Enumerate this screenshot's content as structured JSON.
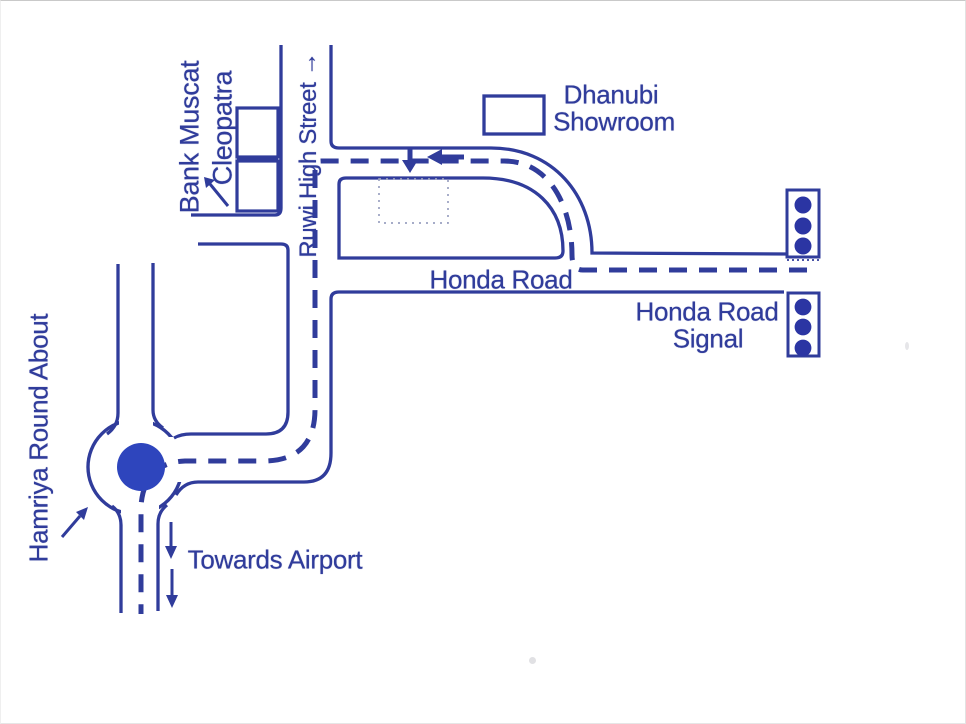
{
  "document": {
    "type": "scanned-direction-map",
    "background": "#ffffff"
  },
  "colors": {
    "ink": "#303c9b",
    "dot": "#2e45bd",
    "signal_fill": "#2b35a3",
    "faint": "#9aa0c0"
  },
  "labels": {
    "bank_muscat": "Bank Muscat",
    "cleopatra": "Cleopatra",
    "ruwi_high_street": "Ruwi High Street →",
    "dhanubi_line1": "Dhanubi",
    "dhanubi_line2": "Showroom",
    "honda_road": "Honda Road",
    "honda_signal_line1": "Honda Road",
    "honda_signal_line2": "Signal",
    "hamriya_roundabout": "Hamriya Round About",
    "towards_airport": "Towards Airport"
  },
  "icons": {
    "signal_upper": "traffic-light-icon",
    "signal_lower": "traffic-light-icon",
    "roundabout_center": "roundabout-dot-icon",
    "route_direction_west": "arrow-left-icon",
    "route_turn_destination": "arrow-down-icon",
    "airport_direction": "arrow-down-icon",
    "cleopatra_pointer": "arrow-up-left-icon",
    "hamriya_pointer": "arrow-up-right-icon",
    "street_direction": "arrow-up-icon"
  },
  "map_features": {
    "roads": [
      "Ruwi High Street",
      "Honda Road"
    ],
    "landmarks": [
      "Bank Muscat",
      "Cleopatra",
      "Dhanubi Showroom",
      "Honda Road Signal",
      "Hamriya Round About"
    ],
    "route_hint": "Dashed route from Honda Road Signal along Honda Road, around the curve past Dhanubi Showroom, down Ruwi High Street to Hamriya Round About, then towards Airport"
  }
}
